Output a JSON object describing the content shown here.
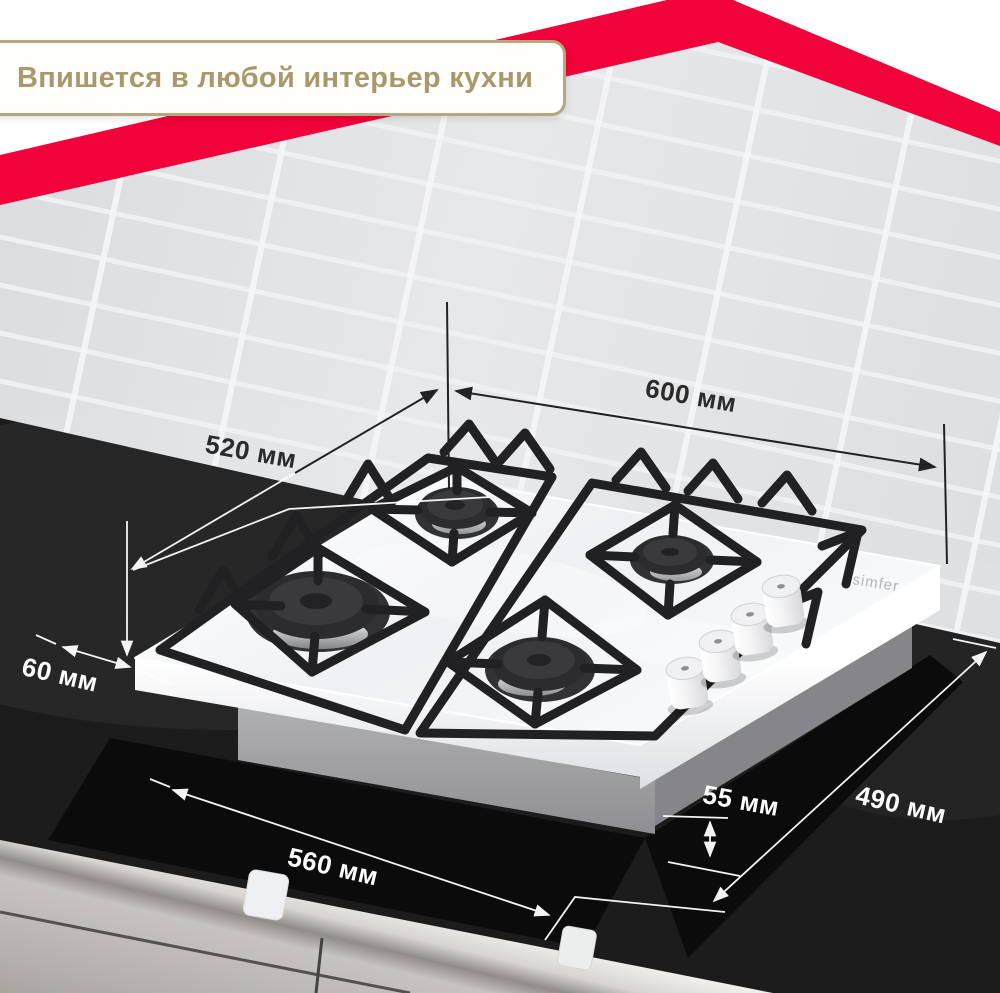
{
  "banner": {
    "text": "Впишется в любой интерьер кухни"
  },
  "brand": {
    "logo": "simfer"
  },
  "dimensions": {
    "width_top": {
      "label": "600 мм"
    },
    "depth_top": {
      "label": "520 мм"
    },
    "side_gap": {
      "label": "60 мм"
    },
    "cutout_width": {
      "label": "560 мм"
    },
    "build_in_height": {
      "label": "55 мм"
    },
    "cutout_depth": {
      "label": "490 мм"
    }
  },
  "colors": {
    "accent_red": "#f2023a",
    "banner_gold": "#a8986c",
    "banner_border": "#b6a77e",
    "label_dark": "#2b2b2b",
    "label_light": "#ffffff",
    "counter_black": "#161616",
    "glass_white": "#f7f8fa"
  }
}
